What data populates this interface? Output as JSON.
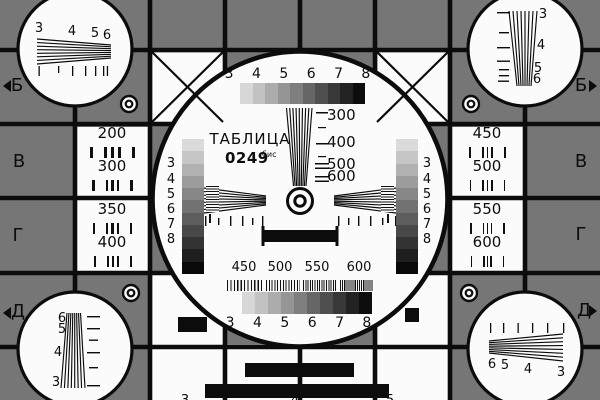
{
  "card": {
    "title": "ТАБЛИЦА",
    "number": "0249",
    "number_suffix": "бис",
    "row_letters": [
      "Б",
      "В",
      "Г",
      "Д"
    ],
    "resolution_groups_top": "3 4 5 6 7 8",
    "resolution_groups_bottom": "3 4 5 6 7 8",
    "center_wedge_scale": [
      "300",
      "400",
      "500",
      "600"
    ],
    "bottom_frequency_scale": [
      "450",
      "500",
      "550",
      "600"
    ],
    "strip_scale": [
      "3",
      "4",
      "5",
      "6",
      "7",
      "8"
    ],
    "left_resolution_boxes": [
      "200",
      "300",
      "350",
      "400"
    ],
    "right_resolution_boxes": [
      "450",
      "500",
      "550",
      "600"
    ],
    "corner_wedge_scales": {
      "top_left": [
        "3",
        "4",
        "5",
        "6"
      ],
      "top_right": [
        "3",
        "4",
        "5",
        "6"
      ],
      "bottom_left": [
        "6",
        "5",
        "4",
        "3"
      ],
      "bottom_right": [
        "6",
        "5",
        "4",
        "3"
      ]
    },
    "edge_digits_top": [
      "2",
      "3",
      "4",
      "5",
      "6",
      "7"
    ],
    "edge_digits_bottom": [
      "3",
      "4",
      "5"
    ],
    "colors": {
      "background": "#767676",
      "line": "#0c0c0c",
      "field": "#fbfbfb"
    },
    "grays10": [
      "#d7d7d7",
      "#c2c2c2",
      "#acacac",
      "#959595",
      "#7e7e7e",
      "#666666",
      "#4f4f4f",
      "#383838",
      "#222222",
      "#0d0d0d"
    ],
    "grays11": [
      "#dadada",
      "#c6c6c6",
      "#b1b1b1",
      "#9c9c9c",
      "#878787",
      "#727272",
      "#5d5d5d",
      "#484848",
      "#333333",
      "#1e1e1e",
      "#090909"
    ]
  }
}
